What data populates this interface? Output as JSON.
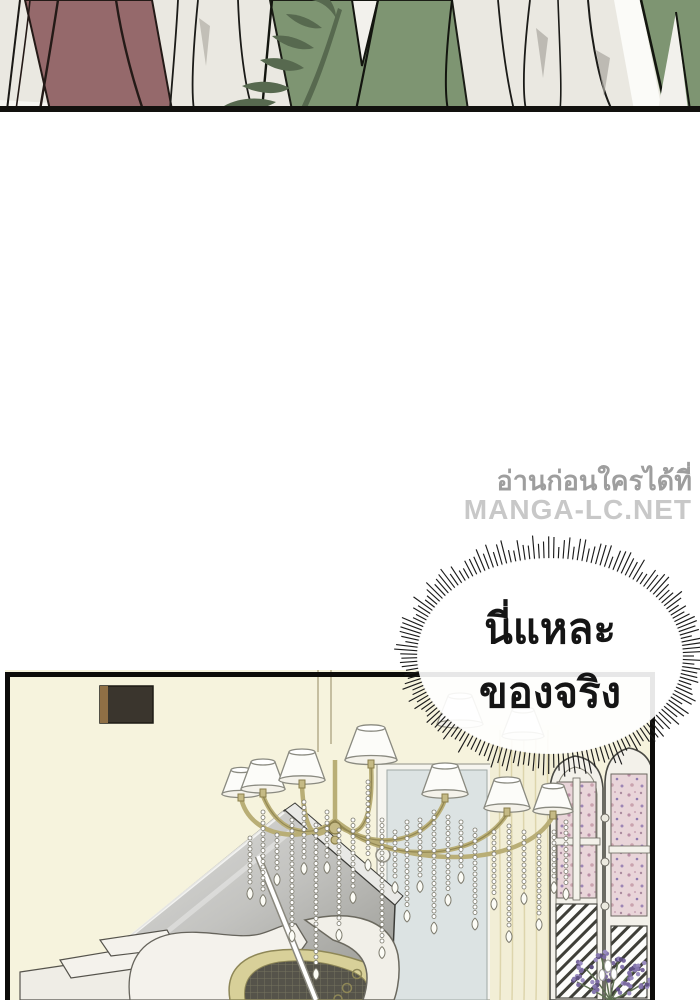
{
  "watermark": {
    "line1": "อ่านก่อนใครได้ที่",
    "line2": "MANGA-LC.NET"
  },
  "speech_bubble": {
    "line1": "นี่แหละ",
    "line2": "ของจริง"
  },
  "colors": {
    "top_panel_bg": "#eae8e1",
    "maroon_skirt": "#95696b",
    "green_jacket": "#7e9572",
    "leaf_dark": "#57694f",
    "ivory_fabric": "#edebe4",
    "panel_line": "#12110e",
    "bottom_panel_bg": "#f6f3dd",
    "panel_border": "#0d0c0a",
    "wall_frame_dark": "#3a352d",
    "wall_frame_brown": "#8f6f45",
    "chandelier_gold": "#b9ae76",
    "lamp_shade": "#fcfcf9",
    "mirror_blue": "#dce3e3",
    "curtain_cream": "#f2eed6",
    "screen_floral_pink": "#e9d5d9",
    "piano_lid_gray": "#b5b5b2",
    "piano_gold": "#d8d099",
    "lavender_purple": "#7c6ba0",
    "watermark_gray": "#9e9e9e",
    "watermark_light_gray": "#c8c8c8",
    "bubble_text": "#151515"
  }
}
